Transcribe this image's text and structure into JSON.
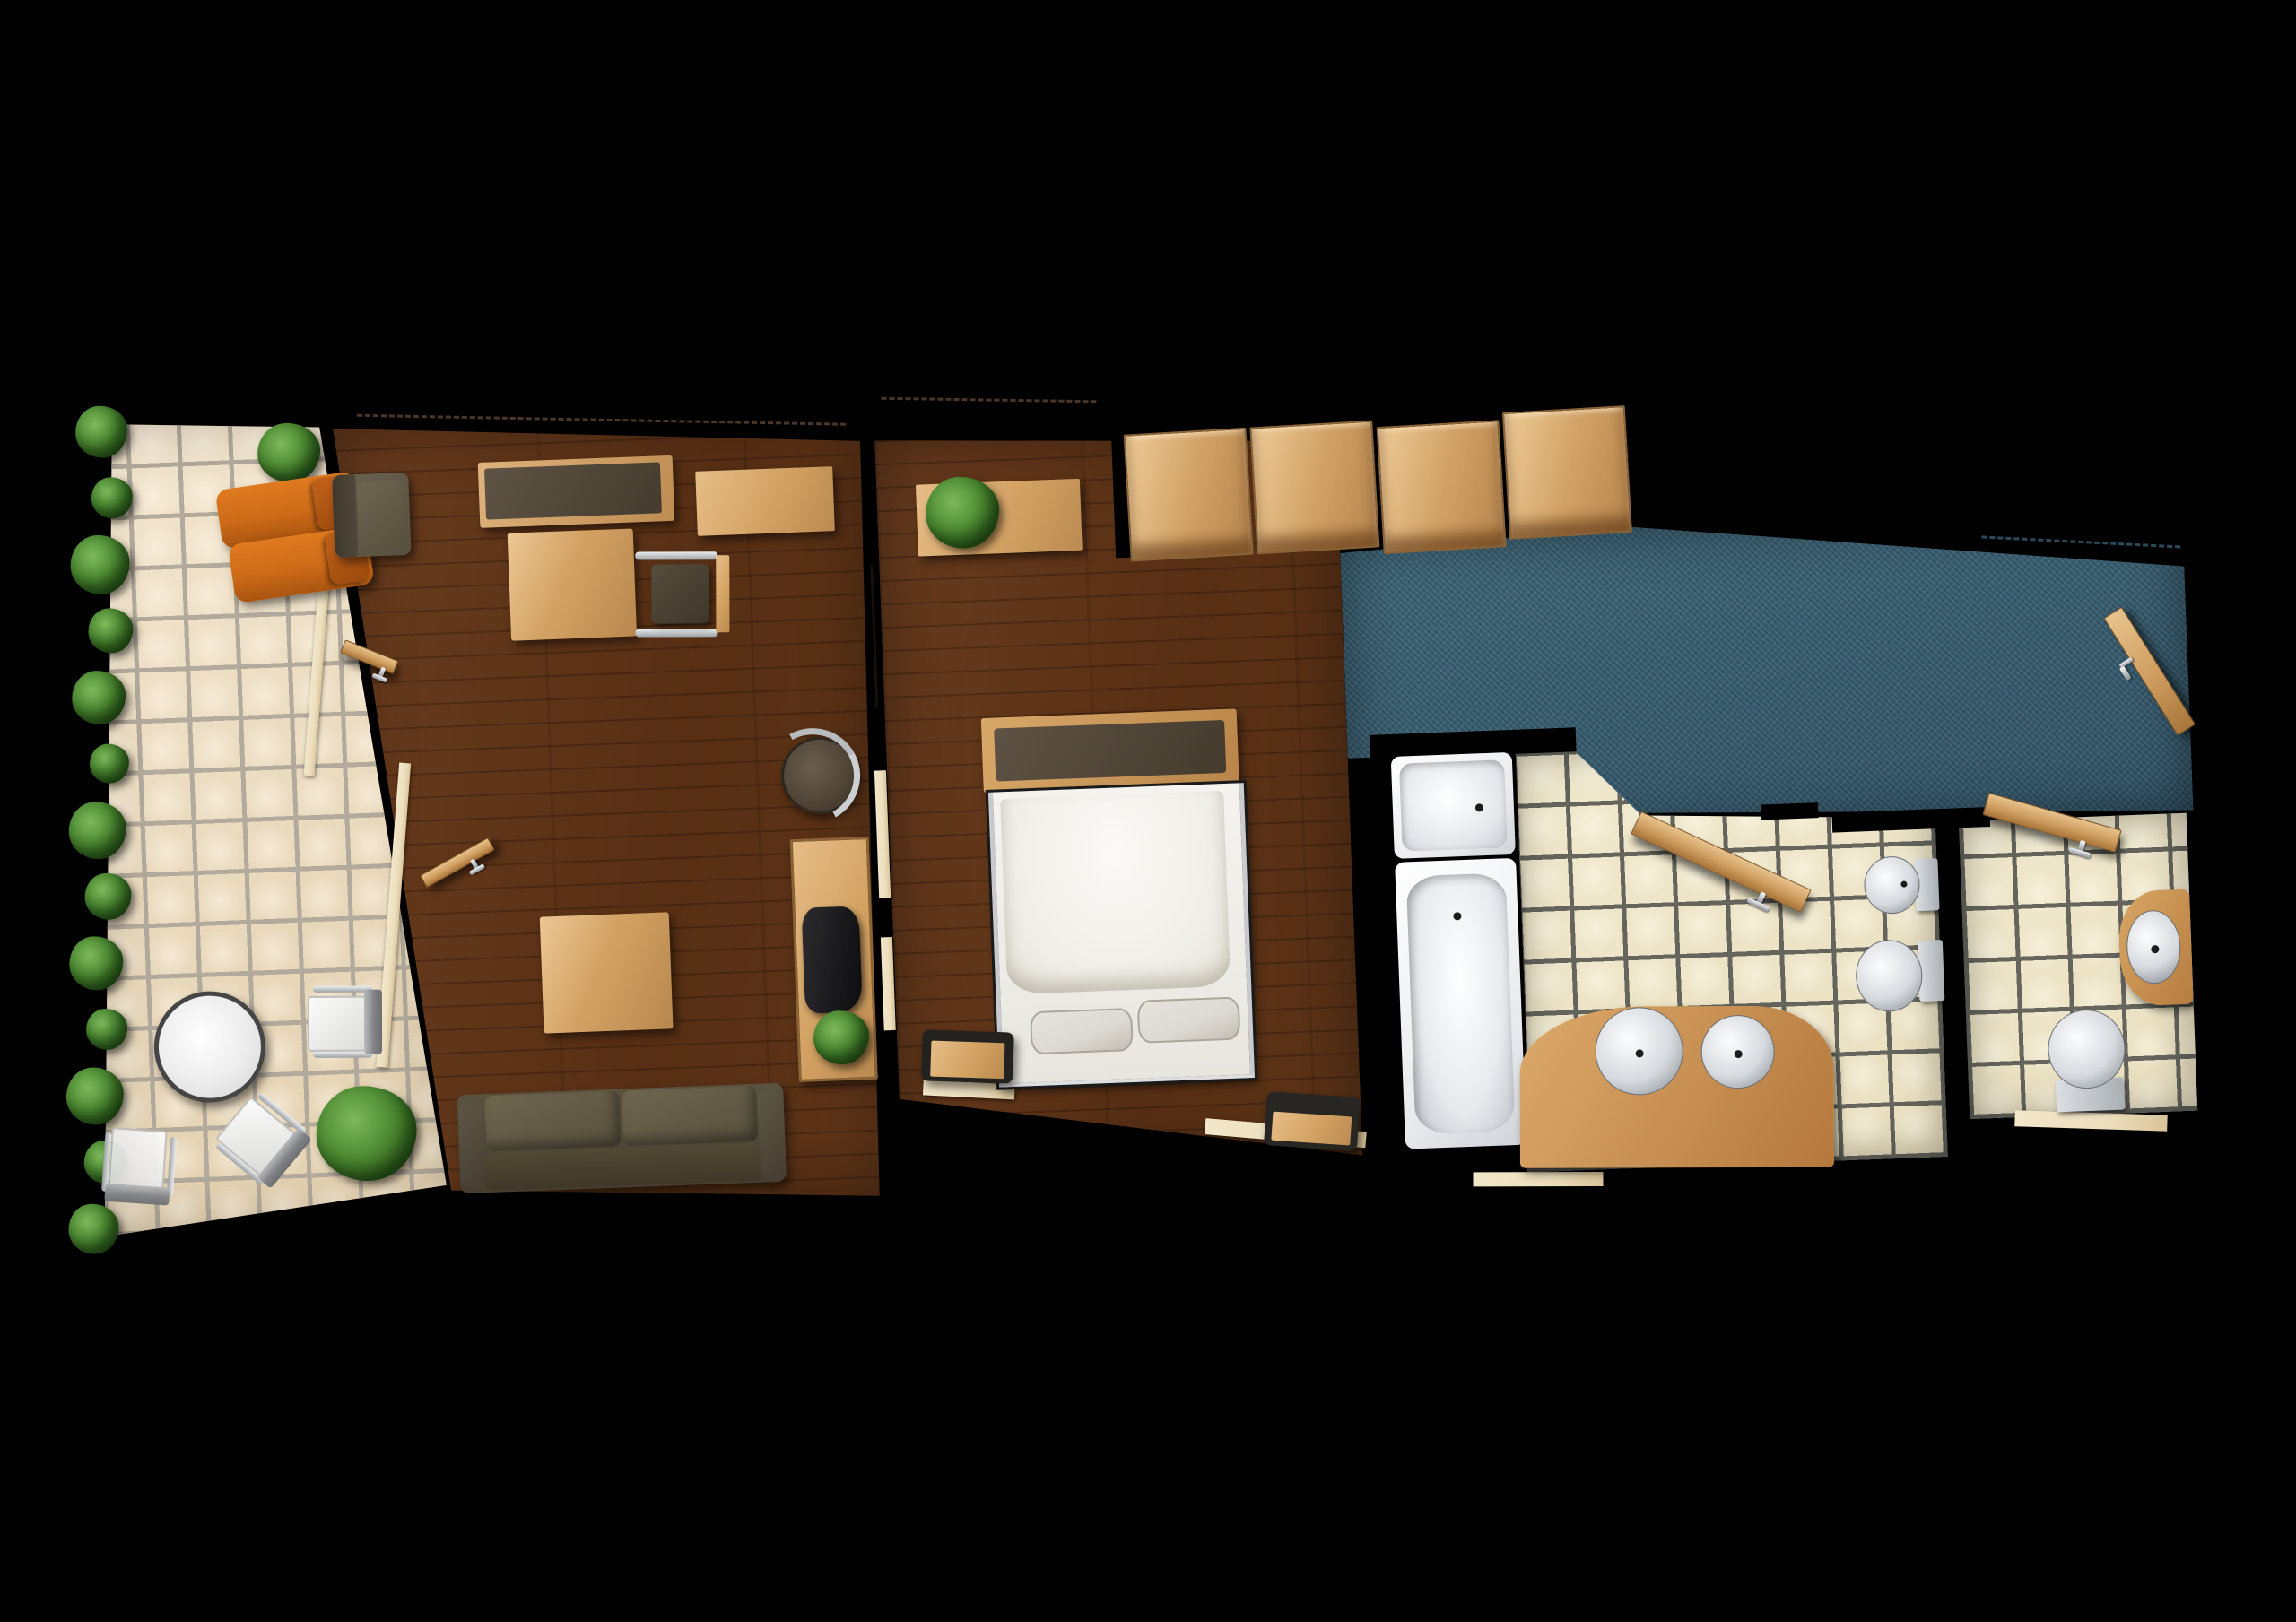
{
  "page": {
    "title": "Hotel suite top-down floor plan"
  },
  "colors": {
    "bg": "#000000",
    "terrace_tile": "#e2cfae",
    "terrace_grout": "#b2aa9c",
    "bath_tile": "#e9dfc0",
    "bath_grout": "#65655e",
    "wood_floor": "#572f14",
    "light_wood": "#d3a263",
    "wood_edge": "#95螺6a35",
    "dark_top": "#54483a",
    "carpet": "#35576a",
    "lounger": "#cd6b18",
    "lounger_dark": "#9c4a0d",
    "upholstery": "#57503f",
    "upholstery_light": "#6b6250",
    "white_fixture": "#f2f2f0",
    "chrome": "#c7cacc",
    "pillow": "#dcd9d2",
    "plant_light": "#7eb85c",
    "plant": "#4e8c33",
    "plant_dark": "#1d3d0f",
    "sill": "#ecdebd",
    "dash_brown": "#4a3626",
    "dash_teal": "#2a4a59"
  },
  "counts": {
    "hedge_bushes": 13,
    "wardrobe_panels": 4,
    "sofa_cushions": 2,
    "vanity_sinks": 2,
    "bed_pillows": 2
  },
  "rooms": [
    {
      "id": "terrace",
      "floor": "ceramic-tile",
      "furniture": [
        "hedge",
        "potted-plant",
        "potted-plant",
        "sun-lounger",
        "sun-lounger",
        "round-table",
        "cafe-chair",
        "cafe-chair",
        "cafe-chair",
        "door-threshold",
        "door-threshold"
      ]
    },
    {
      "id": "living-room",
      "floor": "dark-wood-plank",
      "furniture": [
        "armchair",
        "media-sideboard",
        "wall-shelf",
        "writing-desk",
        "desk-chair",
        "swivel-stool",
        "console-table",
        "console-cushion",
        "potted-plant",
        "coffee-table",
        "sofa",
        "terrace-door-leaf",
        "terrace-door-leaf",
        "sliding-door"
      ]
    },
    {
      "id": "bedroom",
      "floor": "dark-wood-plank",
      "furniture": [
        "window-shelf",
        "potted-plant",
        "wardrobe",
        "double-bed",
        "headboard-bench",
        "pillow",
        "pillow",
        "luggage-bench",
        "luggage-bench",
        "window-sill",
        "window-sill"
      ]
    },
    {
      "id": "entry-corridor",
      "floor": "teal-carpet",
      "furniture": [
        "entry-door-leaf"
      ]
    },
    {
      "id": "bathroom",
      "floor": "ceramic-tile",
      "furniture": [
        "shower",
        "bathtub",
        "vanity-counter",
        "basin",
        "basin",
        "toilet",
        "bidet",
        "door-leaf",
        "threshold"
      ]
    },
    {
      "id": "wc",
      "floor": "ceramic-tile",
      "furniture": [
        "washbasin-cabinet",
        "basin",
        "toilet",
        "door-leaf",
        "threshold"
      ]
    }
  ]
}
